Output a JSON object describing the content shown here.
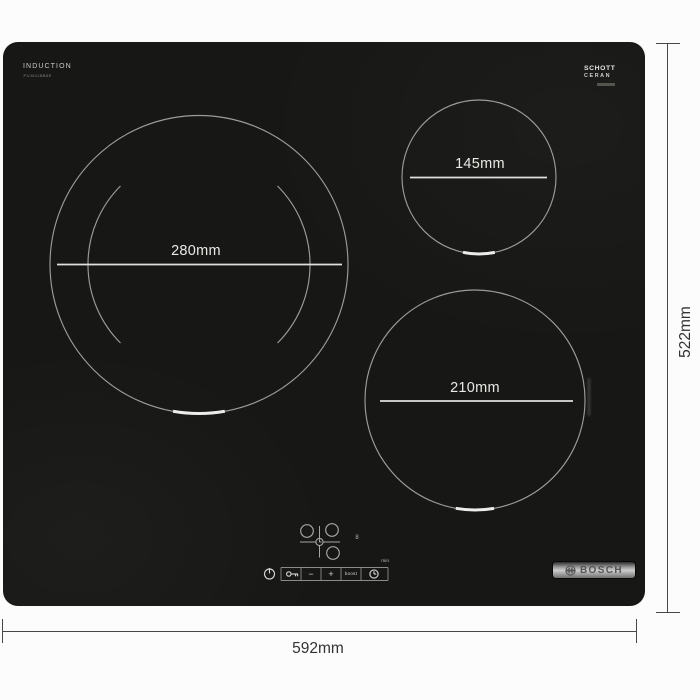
{
  "hob": {
    "surface_color": "#171715",
    "induction_label": "INDUCTION",
    "model_number": "PUJ611BB5E",
    "schott_line1": "SCHOTT",
    "schott_line2": "CERAN",
    "bosch_label": "BOSCH",
    "zones": [
      {
        "id": "left-large",
        "label": "280mm"
      },
      {
        "id": "top-right",
        "label": "145mm"
      },
      {
        "id": "bottom-right",
        "label": "210mm"
      }
    ],
    "controls": {
      "minus_label": "−",
      "plus_label": "+",
      "boost_label": "boost",
      "min_label": "min",
      "timer_display": "8"
    },
    "icons": {
      "power": "power-icon",
      "child_lock": "key-icon",
      "timer": "clock-icon",
      "zone_selector": "zone-cross-icon",
      "bosch_emblem": "bosch-anchor-icon"
    }
  },
  "dimensions": {
    "width_label": "592mm",
    "height_label": "522mm",
    "line_color": "#474747"
  },
  "colors": {
    "zone_ring": "#9c9c98",
    "zone_line": "#e0e0dc",
    "background": "#fcfcfc"
  }
}
